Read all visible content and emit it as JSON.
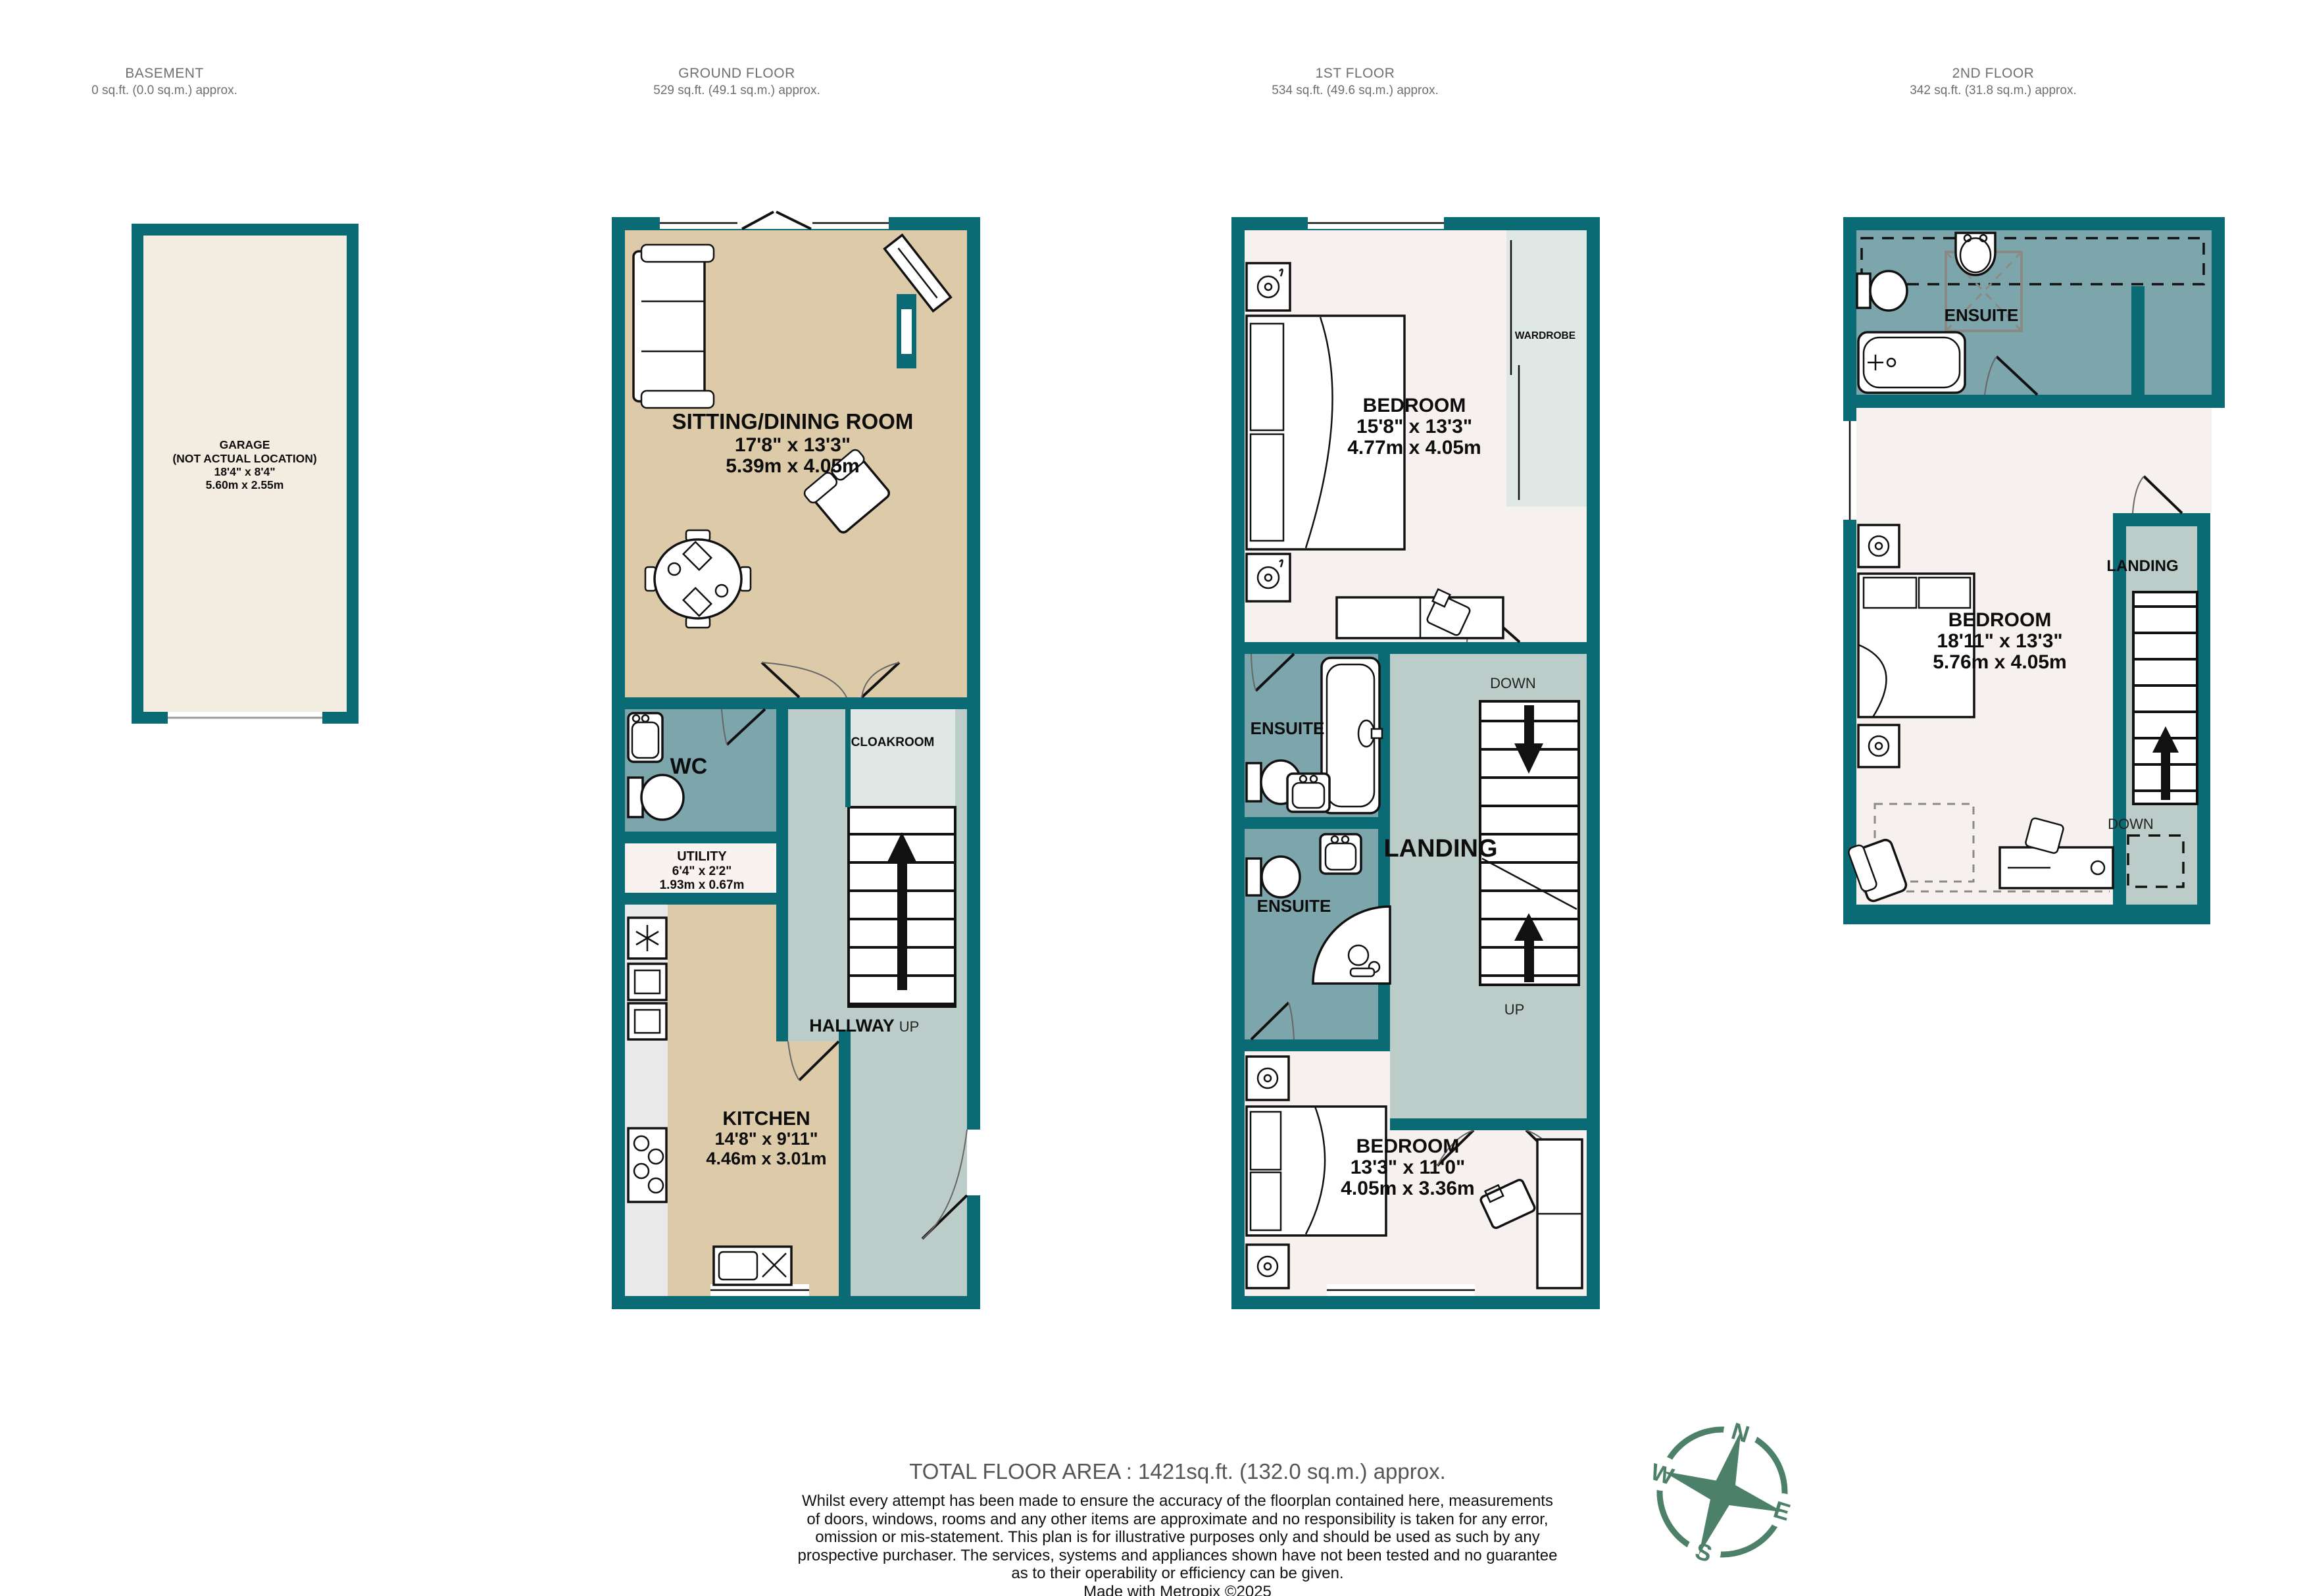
{
  "header": {
    "floors": [
      {
        "name": "BASEMENT",
        "area": "0 sq.ft. (0.0 sq.m.) approx."
      },
      {
        "name": "GROUND FLOOR",
        "area": "529 sq.ft. (49.1 sq.m.) approx."
      },
      {
        "name": "1ST FLOOR",
        "area": "534 sq.ft. (49.6 sq.m.) approx."
      },
      {
        "name": "2ND FLOOR",
        "area": "342 sq.ft. (31.8 sq.m.) approx."
      }
    ]
  },
  "basement": {
    "garage": {
      "l1": "GARAGE",
      "l2": "(NOT ACTUAL LOCATION)",
      "l3": "18'4\"  x 8'4\"",
      "l4": "5.60m  x 2.55m"
    }
  },
  "ground": {
    "sitting": {
      "name": "SITTING/DINING ROOM",
      "imp": "17'8\"  x 13'3\"",
      "met": "5.39m  x 4.05m"
    },
    "wc": "WC",
    "utility": {
      "name": "UTILITY",
      "imp": "6'4\"  x 2'2\"",
      "met": "1.93m  x 0.67m"
    },
    "kitchen": {
      "name": "KITCHEN",
      "imp": "14'8\"  x 9'11\"",
      "met": "4.46m  x 3.01m"
    },
    "cloakroom": "CLOAKROOM",
    "hallway": "HALLWAY",
    "up": "UP"
  },
  "first": {
    "bedroom1": {
      "name": "BEDROOM",
      "imp": "15'8\"  x 13'3\"",
      "met": "4.77m  x 4.05m"
    },
    "wardrobe": "WARDROBE",
    "ensuite1": "ENSUITE",
    "ensuite2": "ENSUITE",
    "landing": "LANDING",
    "down": "DOWN",
    "up": "UP",
    "bedroom2": {
      "name": "BEDROOM",
      "imp": "13'3\"  x 11'0\"",
      "met": "4.05m  x 3.36m"
    }
  },
  "second": {
    "ensuite": "ENSUITE",
    "bedroom": {
      "name": "BEDROOM",
      "imp": "18'11\"  x 13'3\"",
      "met": "5.76m  x 4.05m"
    },
    "landing": "LANDING",
    "down": "DOWN"
  },
  "compass": {
    "n": "N",
    "e": "E",
    "s": "S",
    "w": "W"
  },
  "footer": {
    "total": "TOTAL FLOOR AREA : 1421sq.ft. (132.0 sq.m.) approx.",
    "lines": [
      "Whilst every attempt has been made to ensure the accuracy of the floorplan contained here, measurements",
      "of doors, windows, rooms and any other items are approximate and no responsibility is taken for any error,",
      "omission or mis-statement. This plan is for illustrative purposes only and should be used as such by any",
      "prospective purchaser. The services, systems and appliances shown have not been tested and no guarantee",
      "as to their operability or efficiency can be given.",
      "Made with Metropix ©2025"
    ]
  },
  "colors": {
    "wall": "#0b6b74",
    "room_beige": "#dccaa8",
    "room_pink": "#f6f0ef",
    "hall_grey": "#bccdc9",
    "bath_blue": "#7da5ac",
    "pale": "#dfe8e4",
    "garage_cream": "#f2ede0",
    "compass_green": "#4d8068"
  }
}
